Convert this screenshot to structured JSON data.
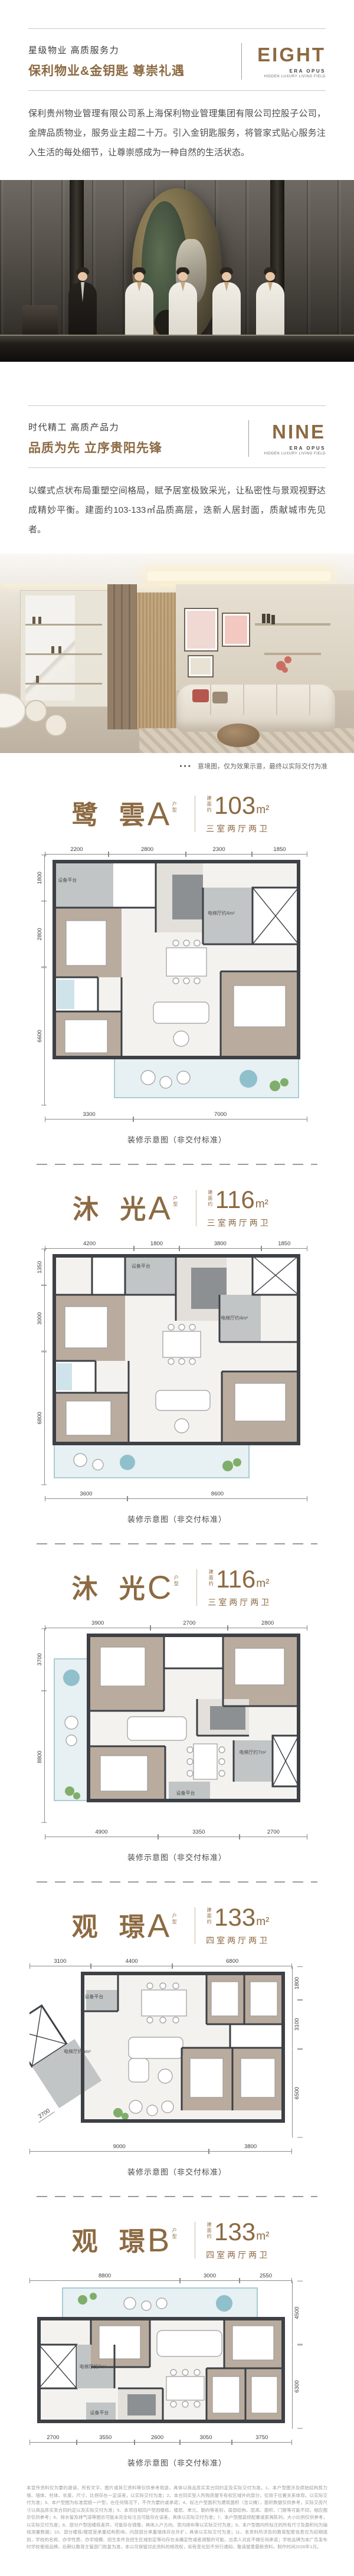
{
  "accent": "#8c6a42",
  "section_eight": {
    "eyebrow": "星级物业 高质服务力",
    "title": "保利物业&金钥匙  尊崇礼遇",
    "logo": "EIGHT",
    "logo_sub1": "ERA OPUS",
    "logo_sub2": "HIDDEN LUXURY LIVING FIELD",
    "body": "保利贵州物业管理有限公司系上海保利物业管理集团有限公司控股子公司，金牌品质物业，服务业主超二十万。引入金钥匙服务，将管家式贴心服务注入生活的每处细节，让尊崇感成为一种自然的生活状态。"
  },
  "section_nine": {
    "eyebrow": "时代精工 高质产品力",
    "title": "品质为先 立序贵阳先锋",
    "logo": "NINE",
    "logo_sub1": "ERA OPUS",
    "logo_sub2": "HIDDEN LUXURY LIVING FIELD",
    "body": "以蝶式点状布局重塑空间格局，赋予居室极致采光，让私密性与景观视野达成精妙平衡。建面约103-133㎡品质高层，迭新人居封面，质献城市先见者。",
    "photo_caption_dots": "●●●",
    "photo_caption": "意境图，仅为效果示意，最终以实际交付为准"
  },
  "plans": [
    {
      "name": "鹭 雲",
      "variant": "A",
      "type_label": "户型",
      "area_prefix": "建面约",
      "area": "103",
      "unit": "m²",
      "spec": "三室两厅两卫",
      "caption": "装修示意图（非交付标准）",
      "rooms": {
        "equipment": "设备平台",
        "elevator": "电梯厅约4m²"
      },
      "dims_top": [
        "2200",
        "2800",
        "2300",
        "1850"
      ],
      "dims_left": [
        "1800",
        "2800",
        "6600"
      ],
      "dims_bottom": [
        "3300",
        "7000"
      ]
    },
    {
      "name": "沐 光",
      "variant": "A",
      "type_label": "户型",
      "area_prefix": "建面约",
      "area": "116",
      "unit": "m²",
      "spec": "三室两厅两卫",
      "caption": "装修示意图（非交付标准）",
      "rooms": {
        "equipment": "设备平台",
        "elevator": "电梯厅约4m²"
      },
      "dims_top": [
        "4200",
        "1800",
        "3800",
        "1850"
      ],
      "dims_left": [
        "1350",
        "3000",
        "6800"
      ],
      "dims_bottom": [
        "3600",
        "8600"
      ]
    },
    {
      "name": "沐 光",
      "variant": "C",
      "type_label": "户型",
      "area_prefix": "建面约",
      "area": "116",
      "unit": "m²",
      "spec": "三室两厅两卫",
      "caption": "装修示意图（非交付标准）",
      "rooms": {
        "equipment": "设备平台",
        "elevator": "电梯厅约7m²"
      },
      "dims_top": [
        "3900",
        "2700",
        "2800"
      ],
      "dims_left": [
        "3700",
        "8800"
      ],
      "dims_bottom": [
        "4900",
        "3350",
        "2700"
      ]
    },
    {
      "name": "观 璟",
      "variant": "A",
      "type_label": "户型",
      "area_prefix": "建面约",
      "area": "133",
      "unit": "m²",
      "spec": "四室两厅两卫",
      "caption": "装修示意图（非交付标准）",
      "rooms": {
        "equipment": "设备平台",
        "elevator": "电梯厅约6m²"
      },
      "dims_top": [
        "3100",
        "4400",
        "6800"
      ],
      "dims_right": [
        "1800",
        "3100",
        "6500"
      ],
      "dims_bottom": [
        "9000",
        "3800"
      ],
      "dim_diag": "2700"
    },
    {
      "name": "观 璟",
      "variant": "B",
      "type_label": "户型",
      "area_prefix": "建面约",
      "area": "133",
      "unit": "m²",
      "spec": "四室两厅两卫",
      "caption": "装修示意图（非交付标准）",
      "rooms": {
        "equipment": "设备平台",
        "elevator": "电梯厅约7m²"
      },
      "dims_top": [
        "8800",
        "3000",
        "2550"
      ],
      "dims_right": [
        "4500",
        "6300"
      ],
      "dims_bottom": [
        "2700",
        "3550",
        "2600",
        "3050",
        "3750"
      ]
    }
  ],
  "disclaimer": "本宣传资料仅为要约邀请，所有文字、图片或其它资料等仅供参考用途，具体以商品房买卖合同约定及实际交付为准。1、本户型图涉及原始结构剪力墙、墙体、柱体、长度、尺寸、比例存在一定误差，以实际交付为准；2、本合同买受人所购房屋专有权区域外的部分，仅用于位置关系体现，以实际交付为准；3、本户型图为标准层统一户型，在任何情况下，不作为要约或承诺；4、标注户型面积为建筑面积（含公摊），面积数据仅供参考，实际交房尺寸以商品房买卖合同约定以及实际交付为准；5、本项目相同户型因楼栋、楼层、单元、朝向等差别，局部结构、层高、面积、门窗等可能不同，相应图示仅供参考；6、排水管及排气道等图示可能未完全标注且可能存在误差，具体以实际交付为准；7、本户型图装修配置或家具陈列，大小比例仅供参考，以实际交付为准；8、部分户型因楼栋差异，可能存在镜像，具体入户方向、室内排布等以实际交付为准；9、本户型图内所标注的所有尺寸及面积均为轴线测量数据；10、部分楼栋/楼层受承重结构影响，内部部分承重墙体存在外扩，具体以实际交付为准；11、本资料所涉及的教育配套信息仅为初期规划，学校的名称、办学性质、办学规模、招生条件及招生区域划定等均存在未确定性或者调整的可能，出卖人对此不做任何承诺；学校品牌为本广告发布时学校使用品牌，后期以教育主管部门批复为准，本公司保留对此资料的修改权，如有变化恕不另行通知，敬请留意最新资料，制作时间2026年1月。"
}
